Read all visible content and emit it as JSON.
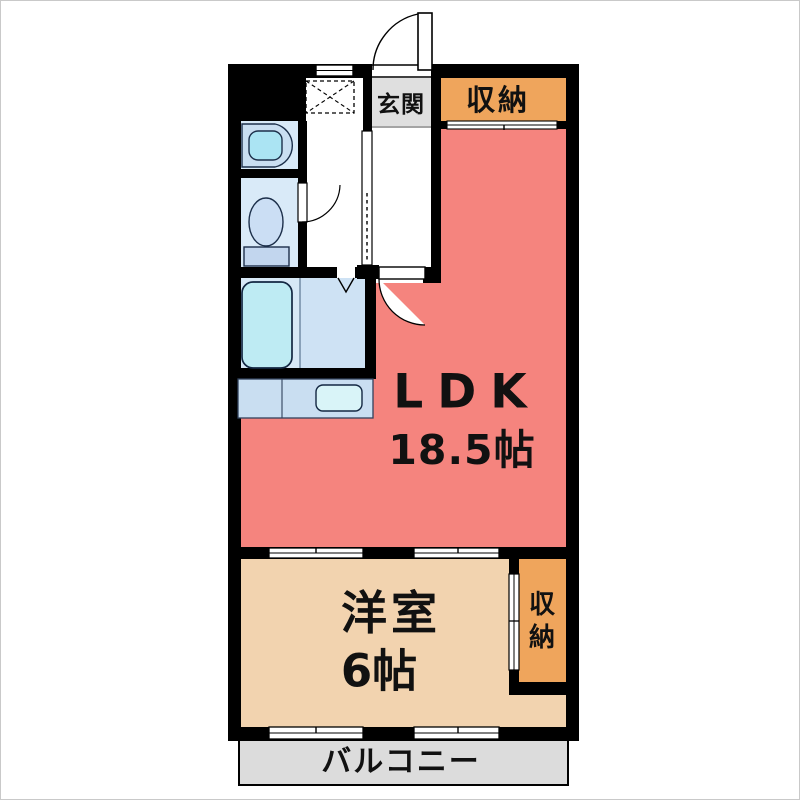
{
  "plan": {
    "genkan": {
      "label": "玄関"
    },
    "storage_top": {
      "label": "収納"
    },
    "ldk": {
      "name": "LDK",
      "size": "18.5帖"
    },
    "bedroom": {
      "name": "洋室",
      "size": "6帖"
    },
    "storage_bedroom": {
      "label": "収納",
      "chars": [
        "収",
        "納"
      ]
    },
    "balcony": {
      "label": "バルコニー"
    }
  },
  "colors": {
    "wall": "#000000",
    "ldk": "#F5847E",
    "bedroom": "#F2D3AF",
    "storage": "#EFA55C",
    "genkan": "#DFDFDF",
    "balcony": "#DCDCDC",
    "wet_floor": "#D9EAF8",
    "bath_floor_left": "#D7E8F6",
    "bath_floor_right": "#CEE2F4",
    "tub": "#BEEBF3",
    "counter": "#C9DEF1",
    "sink": "#D9F4F8",
    "basin_bowl": "#ABE4F3",
    "toilet_tank": "#C2D6EE",
    "toilet_bowl": "#CBDEF4"
  }
}
